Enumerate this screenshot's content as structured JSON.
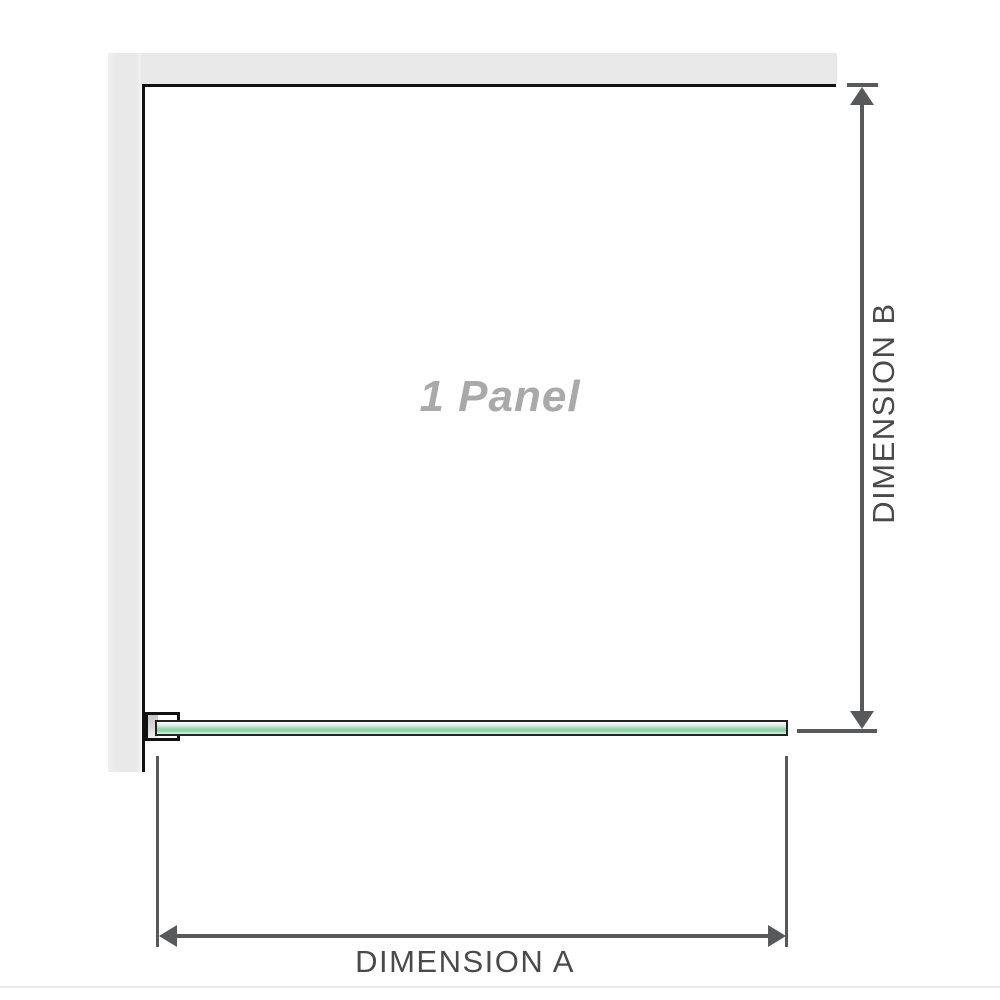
{
  "diagram": {
    "panel_label": "1 Panel",
    "dimension_a": {
      "label": "DIMENSION A"
    },
    "dimension_b": {
      "label": "DIMENSION B"
    }
  },
  "colors": {
    "background": "#ffffff",
    "wall_fill": "#e9e9e9",
    "panel_outline": "#111111",
    "dimension_line": "#58595b",
    "label_text": "#4a4a4a",
    "panel_label_text": "#a9a9a9",
    "glass_green": "#93d2ab",
    "glass_highlight": "#eef8f1"
  },
  "icons": {
    "arrow_up": "dimension arrowhead pointing up",
    "arrow_down": "dimension arrowhead pointing down",
    "arrow_left": "dimension arrowhead pointing left",
    "arrow_right": "dimension arrowhead pointing right"
  }
}
